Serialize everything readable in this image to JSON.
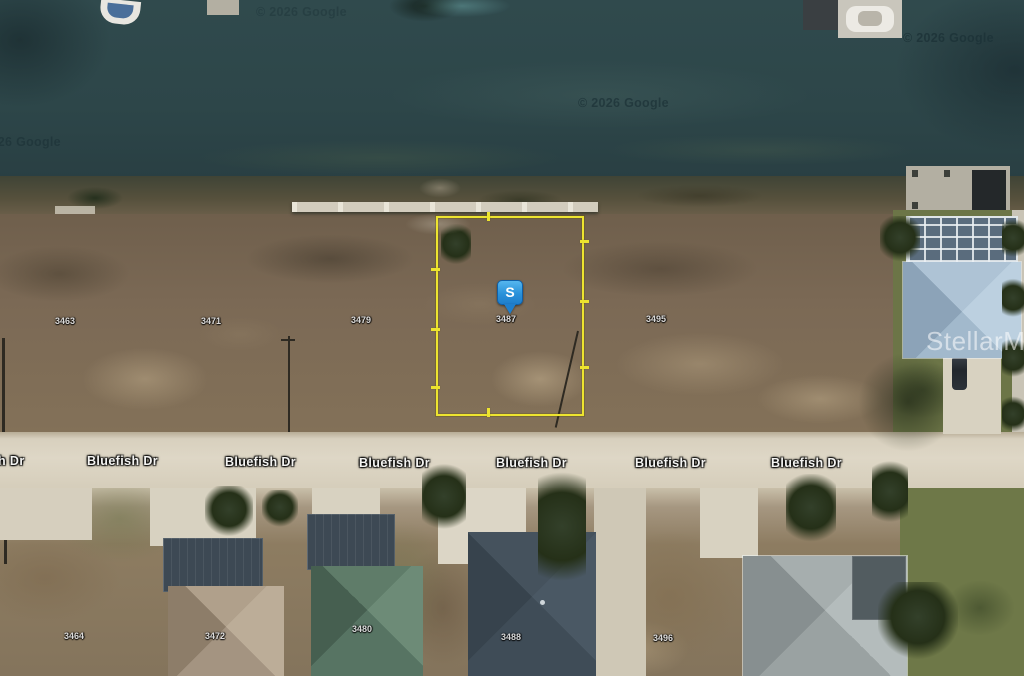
{
  "watermarks": {
    "google": "© 2026 Google",
    "mls": "StellarMLS"
  },
  "road": {
    "name": "Bluefish Dr",
    "labels": [
      "h Dr",
      "Bluefish Dr",
      "Bluefish Dr",
      "Bluefish Dr",
      "Bluefish Dr",
      "Bluefish Dr",
      "Bluefish Dr"
    ]
  },
  "parcels": {
    "north_row": [
      "3463",
      "3471",
      "3479",
      "3487",
      "3495"
    ],
    "south_row": [
      "3464",
      "3472",
      "3480",
      "3488",
      "3496"
    ],
    "selected": "3487"
  },
  "marker": {
    "label": "S"
  },
  "colors": {
    "parcel_outline": "#ede42f",
    "marker_blue": "#2a92da",
    "water": "#2d4649",
    "road_surface": "#d8d0be"
  }
}
